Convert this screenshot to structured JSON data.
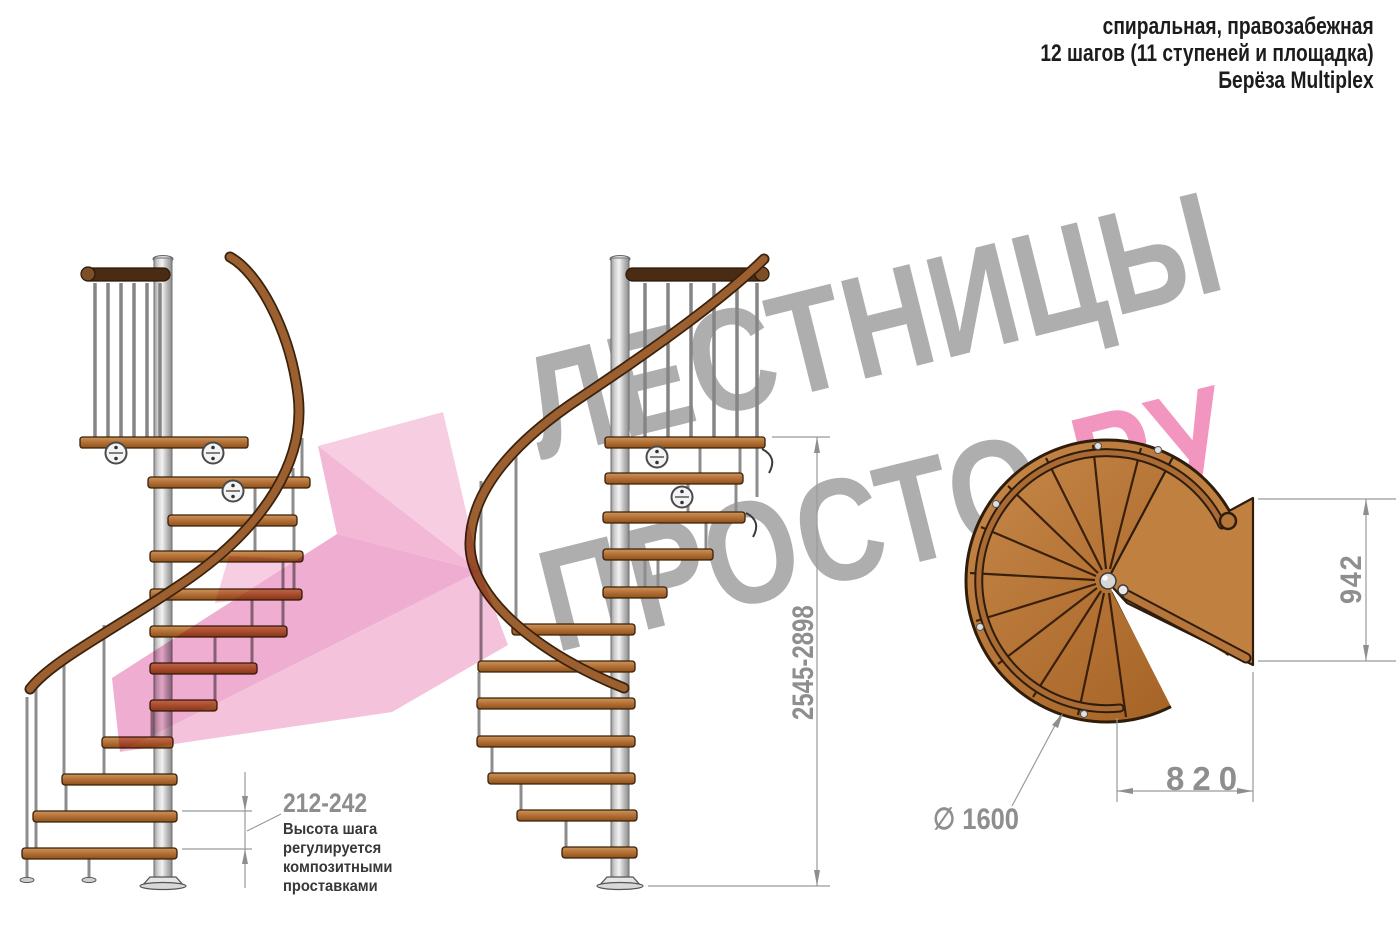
{
  "header": {
    "line1": "спиральная, правозабежная",
    "line2": "12 шагов (11 ступеней и площадка)",
    "line3": "Берёза Multiplex"
  },
  "watermark": {
    "brand_line1": "ЛЕСТНИЦЫ",
    "brand_line2_gray": "ПРОСТО",
    "brand_line2_pink": ".РУ"
  },
  "dimensions": {
    "step_height_range_mm": "212-242",
    "step_note_lines": [
      "Высота шага",
      "регулируется",
      "композитными",
      "проставками"
    ],
    "total_height_range_mm": "2545-2898",
    "landing_depth_mm": "942",
    "landing_width_mm": "820",
    "diameter_label": "∅ 1600"
  },
  "colors": {
    "wood": "#b5733a",
    "dark_rail": "#4a2c15",
    "steel": "#d9d9d9",
    "dimension_gray": "#8e8e8e",
    "note_text": "#383838",
    "watermark_gray": "#ababab",
    "watermark_pink": "#ef87b0",
    "arrow_pink": "#f2b3d4"
  }
}
